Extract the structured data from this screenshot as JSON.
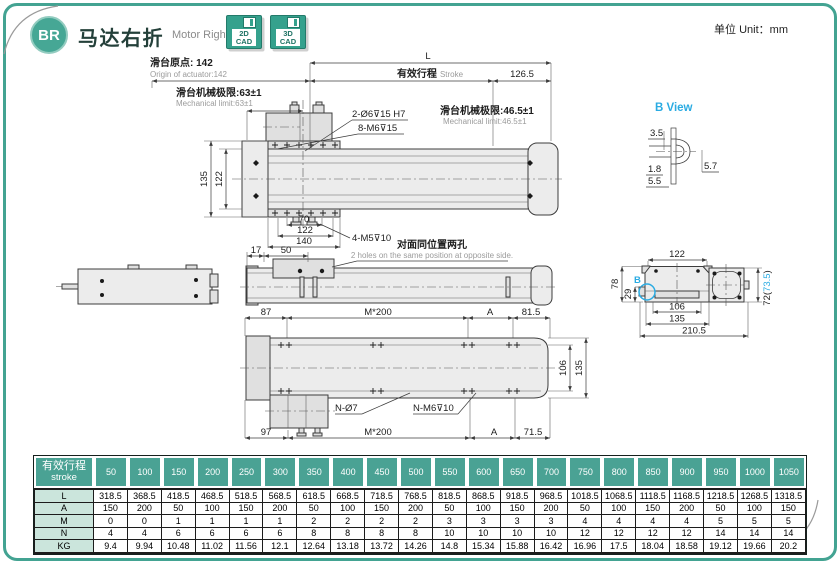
{
  "page": {
    "unit_label": "单位 Unit：mm"
  },
  "colors": {
    "accent": "#43a392",
    "cyan": "#2aabe2",
    "table_header": "#4aa294",
    "row_label_bg": "#cbe5dc"
  },
  "header": {
    "badge": "BR",
    "title_zh": "马达右折",
    "title_en": "Motor Right Side",
    "cad_2d": {
      "line1": "2D",
      "line2": "CAD"
    },
    "cad_3d": {
      "line1": "3D",
      "line2": "CAD"
    }
  },
  "top_view": {
    "origin_zh": "滑台原点: 142",
    "origin_en": "Origin of actuator:142",
    "dim_L": "L",
    "stroke_zh": "有效行程",
    "stroke_en": "Stroke",
    "dim_126_5": "126.5",
    "limit_left_zh": "滑台机械极限:63±1",
    "limit_left_en": "Mechanical limit:63±1",
    "limit_right_zh": "滑台机械极限:46.5±1",
    "limit_right_en": "Mechanical limit:46.5±1",
    "holes1": "2-Ø6⊽15 H7",
    "holes2": "8-M6⊽15",
    "dim_135": "135",
    "dim_122_v": "122",
    "dim_70": "70",
    "dim_122_h": "122",
    "dim_140": "140",
    "holes3": "4-M5⊽10"
  },
  "b_view": {
    "title": "B View",
    "dim_3_5": "3.5",
    "dim_1_8": "1.8",
    "dim_5_5": "5.5",
    "dim_5_7": "5.7"
  },
  "side_view": {
    "dim_17": "17",
    "dim_50": "50",
    "note_zh": "对面同位置两孔",
    "note_en": "2 holes on the same position at opposite side."
  },
  "section_view": {
    "dim_122": "122",
    "dim_78": "78",
    "dim_29": "29",
    "marker_b": "B",
    "dim_106": "106",
    "dim_135": "135",
    "dim_210_5": "210.5",
    "dim_72_open": "72(",
    "dim_73_5": "73.5",
    "dim_72_close": ")"
  },
  "bottom_view": {
    "dim_87": "87",
    "dim_m200_top": "M*200",
    "dim_A_top": "A",
    "dim_81_5": "81.5",
    "dim_106": "106",
    "dim_135": "135",
    "holes_n7": "N-Ø7",
    "holes_nm6": "N-M6⊽10",
    "dim_97": "97",
    "dim_m200_bottom": "M*200",
    "dim_A_bottom": "A",
    "dim_71_5": "71.5"
  },
  "table": {
    "header_zh": "有效行程",
    "header_en": "stroke",
    "strokes": [
      "50",
      "100",
      "150",
      "200",
      "250",
      "300",
      "350",
      "400",
      "450",
      "500",
      "550",
      "600",
      "650",
      "700",
      "750",
      "800",
      "850",
      "900",
      "950",
      "1000",
      "1050"
    ],
    "rows": [
      {
        "label": "L",
        "values": [
          "318.5",
          "368.5",
          "418.5",
          "468.5",
          "518.5",
          "568.5",
          "618.5",
          "668.5",
          "718.5",
          "768.5",
          "818.5",
          "868.5",
          "918.5",
          "968.5",
          "1018.5",
          "1068.5",
          "1118.5",
          "1168.5",
          "1218.5",
          "1268.5",
          "1318.5"
        ]
      },
      {
        "label": "A",
        "values": [
          "150",
          "200",
          "50",
          "100",
          "150",
          "200",
          "50",
          "100",
          "150",
          "200",
          "50",
          "100",
          "150",
          "200",
          "50",
          "100",
          "150",
          "200",
          "50",
          "100",
          "150"
        ]
      },
      {
        "label": "M",
        "values": [
          "0",
          "0",
          "1",
          "1",
          "1",
          "1",
          "2",
          "2",
          "2",
          "2",
          "3",
          "3",
          "3",
          "3",
          "4",
          "4",
          "4",
          "4",
          "5",
          "5",
          "5"
        ]
      },
      {
        "label": "N",
        "values": [
          "4",
          "4",
          "6",
          "6",
          "6",
          "6",
          "8",
          "8",
          "8",
          "8",
          "10",
          "10",
          "10",
          "10",
          "12",
          "12",
          "12",
          "12",
          "14",
          "14",
          "14"
        ]
      },
      {
        "label": "KG",
        "values": [
          "9.4",
          "9.94",
          "10.48",
          "11.02",
          "11.56",
          "12.1",
          "12.64",
          "13.18",
          "13.72",
          "14.26",
          "14.8",
          "15.34",
          "15.88",
          "16.42",
          "16.96",
          "17.5",
          "18.04",
          "18.58",
          "19.12",
          "19.66",
          "20.2"
        ]
      }
    ]
  }
}
